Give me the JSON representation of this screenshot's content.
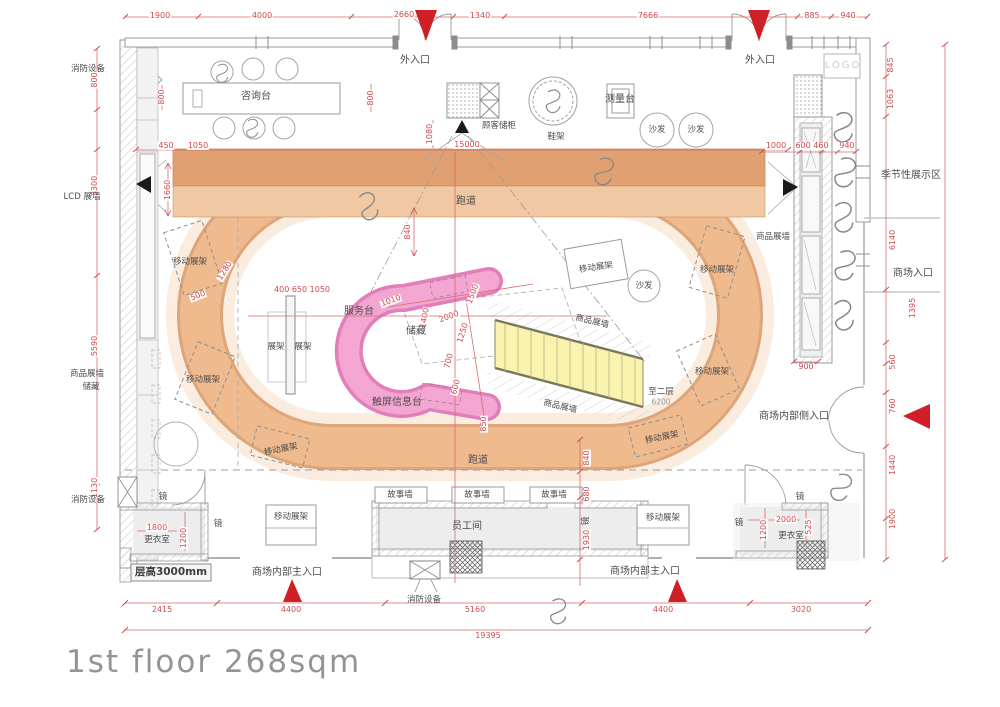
{
  "title": {
    "text": "1st floor 268sqm"
  },
  "colors": {
    "dimension_red": "#cf4b4e",
    "arrow_red": "#cf2027",
    "track_band": "#efba8f",
    "track_dark": "#e1a072",
    "service_pink": "#f3a6d2",
    "stairs_yellow": "#f8f2ab",
    "wall_gray": "#9a9a9a"
  },
  "plan": {
    "labels": [
      {
        "t": "1900",
        "x": 160,
        "y": 16,
        "c": "dim"
      },
      {
        "t": "4000",
        "x": 262,
        "y": 16,
        "c": "dim"
      },
      {
        "t": "2660",
        "x": 404,
        "y": 15,
        "c": "dim"
      },
      {
        "t": "1340",
        "x": 480,
        "y": 16,
        "c": "dim"
      },
      {
        "t": "7666",
        "x": 648,
        "y": 16,
        "c": "dim"
      },
      {
        "t": "885",
        "x": 812,
        "y": 16,
        "c": "dim"
      },
      {
        "t": "940",
        "x": 848,
        "y": 16,
        "c": "dim"
      },
      {
        "t": "2415",
        "x": 162,
        "y": 610,
        "c": "dim"
      },
      {
        "t": "4400",
        "x": 291,
        "y": 610,
        "c": "dim"
      },
      {
        "t": "5160",
        "x": 475,
        "y": 610,
        "c": "dim"
      },
      {
        "t": "4400",
        "x": 663,
        "y": 610,
        "c": "dim"
      },
      {
        "t": "3020",
        "x": 801,
        "y": 610,
        "c": "dim"
      },
      {
        "t": "19395",
        "x": 488,
        "y": 636,
        "c": "dim"
      },
      {
        "t": "800",
        "x": 95,
        "y": 80,
        "c": "dimv",
        "r": -90
      },
      {
        "t": "3300",
        "x": 95,
        "y": 186,
        "c": "dimv",
        "r": -90
      },
      {
        "t": "5590",
        "x": 95,
        "y": 346,
        "c": "dimv",
        "r": -90
      },
      {
        "t": "1130",
        "x": 95,
        "y": 488,
        "c": "dimv",
        "r": -90
      },
      {
        "t": "450",
        "x": 166,
        "y": 146,
        "c": "dim"
      },
      {
        "t": "1050",
        "x": 198,
        "y": 146,
        "c": "dim"
      },
      {
        "t": "800",
        "x": 162,
        "y": 97,
        "c": "dimv",
        "r": -90
      },
      {
        "t": "800",
        "x": 371,
        "y": 98,
        "c": "dimv",
        "r": -90
      },
      {
        "t": "1660",
        "x": 168,
        "y": 190,
        "c": "dimv",
        "r": -90
      },
      {
        "t": "845",
        "x": 891,
        "y": 65,
        "c": "dimv",
        "r": -90
      },
      {
        "t": "1063",
        "x": 891,
        "y": 99,
        "c": "dimv",
        "r": -90
      },
      {
        "t": "6140",
        "x": 893,
        "y": 240,
        "c": "dimv",
        "r": -90
      },
      {
        "t": "1395",
        "x": 913,
        "y": 308,
        "c": "dimv",
        "r": -90
      },
      {
        "t": "560",
        "x": 893,
        "y": 362,
        "c": "dimv",
        "r": -90
      },
      {
        "t": "760",
        "x": 893,
        "y": 406,
        "c": "dimv",
        "r": -90
      },
      {
        "t": "1440",
        "x": 893,
        "y": 465,
        "c": "dimv",
        "r": -90
      },
      {
        "t": "1900",
        "x": 893,
        "y": 519,
        "c": "dimv",
        "r": -90
      },
      {
        "t": "1000",
        "x": 776,
        "y": 146,
        "c": "dim"
      },
      {
        "t": "600 460",
        "x": 812,
        "y": 146,
        "c": "dim"
      },
      {
        "t": "940",
        "x": 847,
        "y": 146,
        "c": "dim"
      },
      {
        "t": "900",
        "x": 806,
        "y": 367,
        "c": "dim"
      },
      {
        "t": "15000",
        "x": 467,
        "y": 145,
        "c": "dim"
      },
      {
        "t": "1080",
        "x": 430,
        "y": 134,
        "c": "dimv",
        "r": -90
      },
      {
        "t": "840",
        "x": 408,
        "y": 232,
        "c": "dimv",
        "r": -90
      },
      {
        "t": "840",
        "x": 587,
        "y": 458,
        "c": "dimv",
        "r": -90
      },
      {
        "t": "680",
        "x": 587,
        "y": 494,
        "c": "dimv",
        "r": -90
      },
      {
        "t": "1930",
        "x": 587,
        "y": 540,
        "c": "dimv",
        "r": -90
      },
      {
        "t": "400 650 1050",
        "x": 302,
        "y": 290,
        "c": "dim"
      },
      {
        "t": "1010",
        "x": 391,
        "y": 301,
        "c": "dim",
        "r": -20
      },
      {
        "t": "2000",
        "x": 449,
        "y": 317,
        "c": "dim",
        "r": -20
      },
      {
        "t": "1250",
        "x": 463,
        "y": 333,
        "c": "dim",
        "r": -72
      },
      {
        "t": "1400",
        "x": 425,
        "y": 318,
        "c": "dim",
        "r": -80
      },
      {
        "t": "700",
        "x": 449,
        "y": 361,
        "c": "dim",
        "r": -75
      },
      {
        "t": "600",
        "x": 456,
        "y": 387,
        "c": "dim",
        "r": -75
      },
      {
        "t": "850",
        "x": 484,
        "y": 424,
        "c": "dimv",
        "r": -90
      },
      {
        "t": "1500",
        "x": 473,
        "y": 294,
        "c": "dim",
        "r": -70
      },
      {
        "t": "1280",
        "x": 225,
        "y": 271,
        "c": "dim",
        "r": -58
      },
      {
        "t": "500",
        "x": 198,
        "y": 296,
        "c": "dim",
        "r": -20
      },
      {
        "t": "1800",
        "x": 157,
        "y": 528,
        "c": "dim"
      },
      {
        "t": "1200",
        "x": 184,
        "y": 538,
        "c": "dimv",
        "r": -90
      },
      {
        "t": "2000",
        "x": 786,
        "y": 520,
        "c": "dim"
      },
      {
        "t": "1200",
        "x": 764,
        "y": 530,
        "c": "dimv",
        "r": -90
      },
      {
        "t": "525",
        "x": 809,
        "y": 527,
        "c": "dimv",
        "r": -90
      },
      {
        "t": "6200",
        "x": 661,
        "y": 402,
        "c": "gdim"
      },
      {
        "t": "消防设备",
        "x": 88,
        "y": 69,
        "c": "sm",
        "n": "label-fire-equipment"
      },
      {
        "t": "外入口",
        "x": 415,
        "y": 61,
        "c": "lbl",
        "n": "label-exterior-entrance"
      },
      {
        "t": "外入口",
        "x": 760,
        "y": 61,
        "c": "lbl",
        "n": "label-exterior-entrance"
      },
      {
        "t": "咨询台",
        "x": 256,
        "y": 97,
        "c": "lbl",
        "n": "label-consultation-desk"
      },
      {
        "t": "顾客储柜",
        "x": 499,
        "y": 126,
        "c": "sm",
        "n": "label-customer-lockers"
      },
      {
        "t": "鞋架",
        "x": 556,
        "y": 137,
        "c": "sm",
        "n": "label-shoe-rack"
      },
      {
        "t": "测量台",
        "x": 620,
        "y": 100,
        "c": "lbl",
        "n": "label-measuring-table"
      },
      {
        "t": "沙发",
        "x": 657,
        "y": 130,
        "c": "sm",
        "n": "label-sofa"
      },
      {
        "t": "沙发",
        "x": 696,
        "y": 130,
        "c": "sm",
        "n": "label-sofa"
      },
      {
        "t": "LOGO",
        "x": 843,
        "y": 66,
        "c": "logo",
        "n": "logo-box"
      },
      {
        "t": "季节性展示区",
        "x": 911,
        "y": 176,
        "c": "lbl",
        "n": "label-seasonal-display-area"
      },
      {
        "t": "商场入口",
        "x": 913,
        "y": 274,
        "c": "lbl",
        "n": "label-mall-entrance"
      },
      {
        "t": "LCD 展墙",
        "x": 82,
        "y": 197,
        "c": "sm",
        "n": "label-lcd-wall"
      },
      {
        "t": "跑道",
        "x": 466,
        "y": 202,
        "c": "lbl",
        "n": "label-running-track"
      },
      {
        "t": "跑道",
        "x": 478,
        "y": 461,
        "c": "lbl",
        "n": "label-running-track"
      },
      {
        "t": "商品展墙",
        "x": 87,
        "y": 374,
        "c": "sm",
        "n": "label-product-wall"
      },
      {
        "t": "储藏",
        "x": 91,
        "y": 387,
        "c": "sm",
        "n": "label-storage"
      },
      {
        "t": "移动展架",
        "x": 190,
        "y": 262,
        "c": "sm",
        "n": "label-mobile-rack"
      },
      {
        "t": "移动展架",
        "x": 203,
        "y": 380,
        "c": "sm",
        "n": "label-mobile-rack"
      },
      {
        "t": "移动展架",
        "x": 281,
        "y": 450,
        "c": "sm",
        "r": -12,
        "n": "label-mobile-rack"
      },
      {
        "t": "移动展架",
        "x": 291,
        "y": 517,
        "c": "sm",
        "n": "label-mobile-rack"
      },
      {
        "t": "移动展架",
        "x": 596,
        "y": 268,
        "c": "sm",
        "r": -8,
        "n": "label-mobile-rack"
      },
      {
        "t": "移动展架",
        "x": 717,
        "y": 270,
        "c": "sm",
        "n": "label-mobile-rack"
      },
      {
        "t": "移动展架",
        "x": 712,
        "y": 372,
        "c": "sm",
        "n": "label-mobile-rack"
      },
      {
        "t": "移动展架",
        "x": 662,
        "y": 438,
        "c": "sm",
        "r": -12,
        "n": "label-mobile-rack"
      },
      {
        "t": "移动展架",
        "x": 663,
        "y": 518,
        "c": "sm",
        "n": "label-mobile-rack"
      },
      {
        "t": "商品展墙",
        "x": 773,
        "y": 237,
        "c": "sm",
        "n": "label-product-wall"
      },
      {
        "t": "服务台",
        "x": 359,
        "y": 312,
        "c": "lbl",
        "n": "label-service-desk"
      },
      {
        "t": "储藏",
        "x": 416,
        "y": 332,
        "c": "lbl",
        "n": "label-storage"
      },
      {
        "t": "触屏信息台",
        "x": 397,
        "y": 403,
        "c": "lbl",
        "n": "label-touchscreen-info-desk"
      },
      {
        "t": "展架",
        "x": 276,
        "y": 347,
        "c": "sm",
        "n": "label-rack"
      },
      {
        "t": "展架",
        "x": 303,
        "y": 347,
        "c": "sm",
        "n": "label-rack"
      },
      {
        "t": "商品展墙",
        "x": 592,
        "y": 322,
        "c": "sm",
        "r": 13,
        "n": "label-product-wall"
      },
      {
        "t": "商品展墙",
        "x": 560,
        "y": 407,
        "c": "sm",
        "r": 13,
        "n": "label-product-wall"
      },
      {
        "t": "至二层",
        "x": 661,
        "y": 392,
        "c": "sm",
        "n": "label-to-second-floor"
      },
      {
        "t": "沙发",
        "x": 644,
        "y": 286,
        "c": "sm",
        "n": "label-sofa"
      },
      {
        "t": "故事墙",
        "x": 400,
        "y": 495,
        "c": "sm",
        "n": "label-story-wall"
      },
      {
        "t": "故事墙",
        "x": 477,
        "y": 495,
        "c": "sm",
        "n": "label-story-wall"
      },
      {
        "t": "故事墙",
        "x": 554,
        "y": 495,
        "c": "sm",
        "n": "label-story-wall"
      },
      {
        "t": "员工间",
        "x": 467,
        "y": 527,
        "c": "lbl",
        "n": "label-staff-room"
      },
      {
        "t": "镜",
        "x": 163,
        "y": 497,
        "c": "sm",
        "n": "label-mirror"
      },
      {
        "t": "镜",
        "x": 218,
        "y": 524,
        "c": "sm",
        "n": "label-mirror"
      },
      {
        "t": "镜",
        "x": 586,
        "y": 521,
        "c": "sm",
        "r": -90,
        "n": "label-mirror"
      },
      {
        "t": "镜",
        "x": 800,
        "y": 497,
        "c": "sm",
        "n": "label-mirror"
      },
      {
        "t": "镜",
        "x": 739,
        "y": 523,
        "c": "sm",
        "n": "label-mirror"
      },
      {
        "t": "更衣室",
        "x": 157,
        "y": 540,
        "c": "sm",
        "n": "label-changing-room"
      },
      {
        "t": "更衣室",
        "x": 791,
        "y": 536,
        "c": "sm",
        "n": "label-changing-room"
      },
      {
        "t": "层高3000mm",
        "x": 171,
        "y": 572,
        "c": "note",
        "n": "label-ceiling-height"
      },
      {
        "t": "消防设备",
        "x": 424,
        "y": 600,
        "c": "sm",
        "n": "label-fire-equipment"
      },
      {
        "t": "消防设备",
        "x": 88,
        "y": 500,
        "c": "sm",
        "n": "label-fire-equipment"
      },
      {
        "t": "商场内部主入口",
        "x": 287,
        "y": 573,
        "c": "lbl",
        "n": "label-interior-main-entrance"
      },
      {
        "t": "商场内部主入口",
        "x": 645,
        "y": 572,
        "c": "lbl",
        "n": "label-interior-main-entrance"
      },
      {
        "t": "商场内部侧入口",
        "x": 794,
        "y": 417,
        "c": "lbl",
        "n": "label-interior-side-entrance"
      }
    ]
  }
}
